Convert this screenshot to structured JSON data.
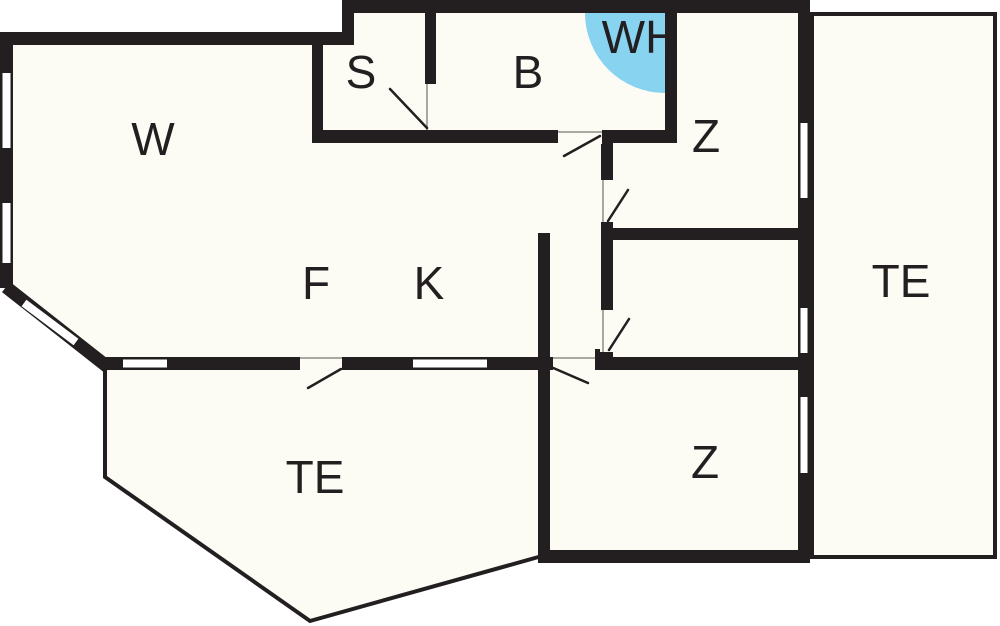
{
  "plan": {
    "type": "floor-plan",
    "colors": {
      "wall": "#231F20",
      "floor": "#FCFCF5",
      "whirlpool": "#87D3F0",
      "background": "#FFFFFF",
      "threshold": "#A9A9A2"
    },
    "rooms": [
      {
        "id": "living-room",
        "label": "W",
        "x": 153,
        "y": 155
      },
      {
        "id": "sauna",
        "label": "S",
        "x": 361,
        "y": 88
      },
      {
        "id": "bathroom",
        "label": "B",
        "x": 528,
        "y": 88
      },
      {
        "id": "whirlpool-corner",
        "label": "WH",
        "x": 640,
        "y": 53
      },
      {
        "id": "bedroom-top",
        "label": "Z",
        "x": 706,
        "y": 152
      },
      {
        "id": "hall",
        "label": "F",
        "x": 316,
        "y": 299
      },
      {
        "id": "kitchen",
        "label": "K",
        "x": 429,
        "y": 299
      },
      {
        "id": "terrace-right",
        "label": "TE",
        "x": 901,
        "y": 297
      },
      {
        "id": "bedroom-bottom",
        "label": "Z",
        "x": 705,
        "y": 478
      },
      {
        "id": "terrace-bottom",
        "label": "TE",
        "x": 315,
        "y": 493
      }
    ],
    "features": {
      "doors": 6,
      "windows": 8,
      "whirlpool_marker": "quarter-circle"
    }
  }
}
